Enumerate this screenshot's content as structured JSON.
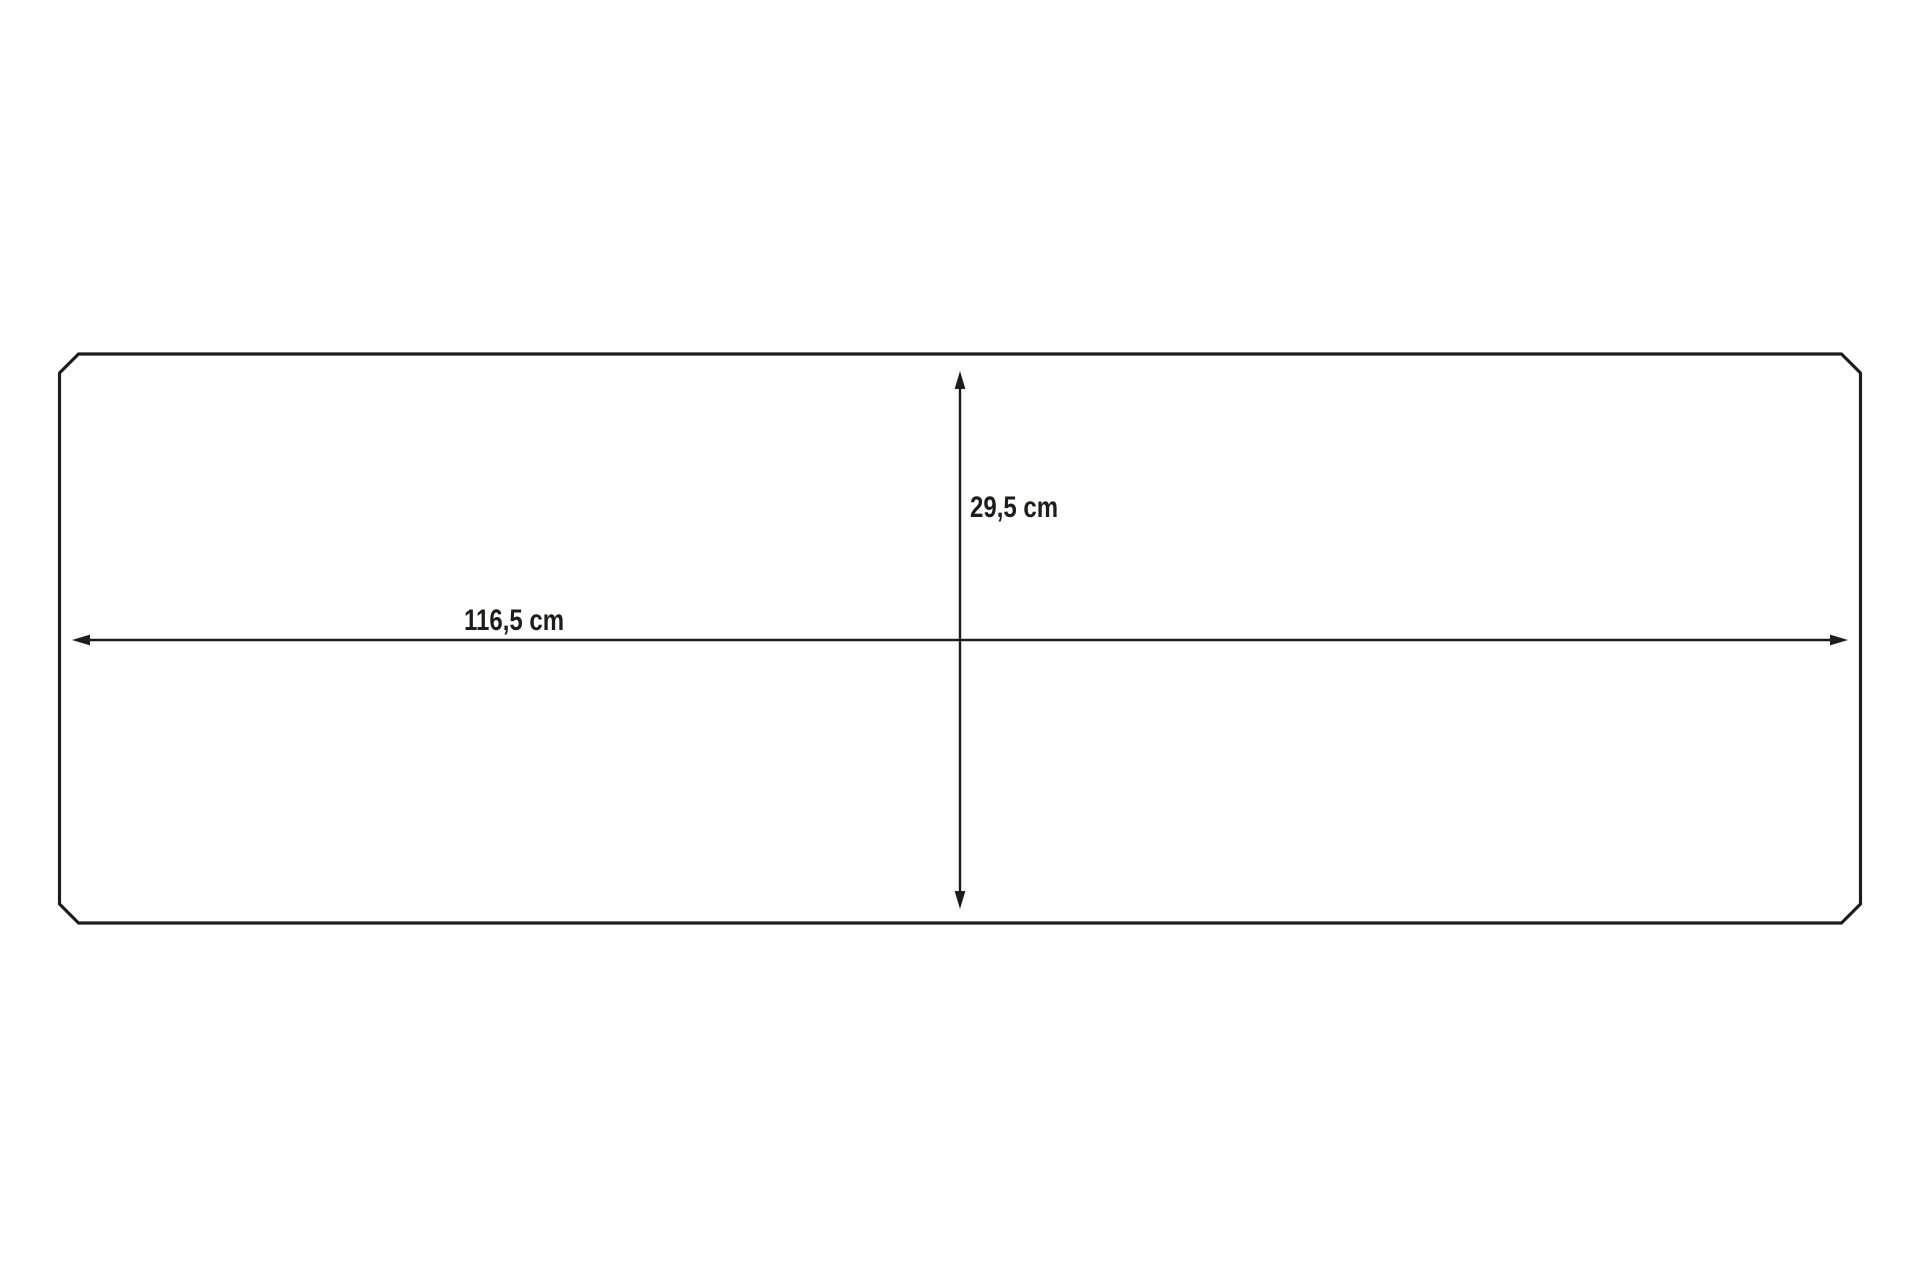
{
  "canvas": {
    "background": "#ffffff",
    "line_color": "#1d1d1b"
  },
  "diagram": {
    "shape": "chamfered-rectangle-outline",
    "width_dimension": {
      "label": "116,5 cm"
    },
    "height_dimension": {
      "label": "29,5 cm"
    }
  }
}
